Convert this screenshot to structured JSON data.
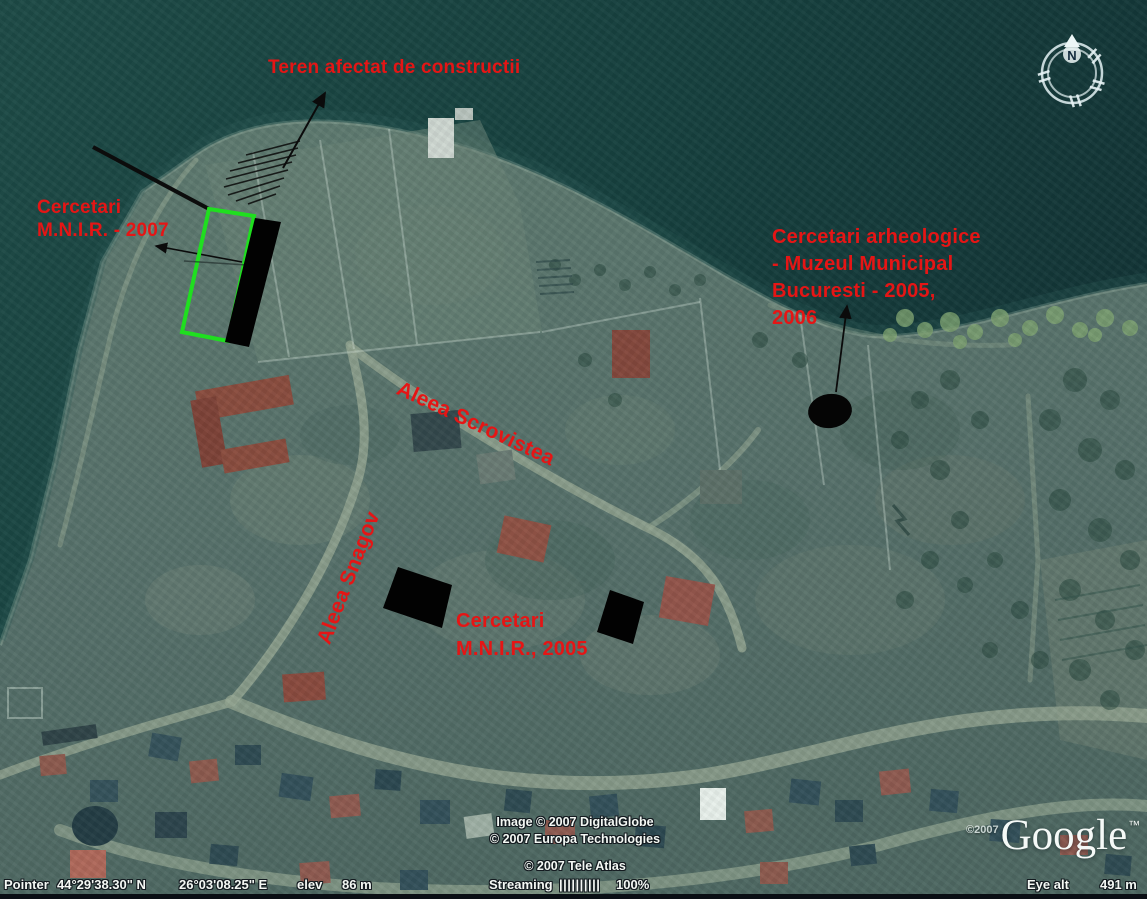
{
  "annotations": {
    "construction_label": "Teren afectat de constructii",
    "mnir_2007": {
      "line1": "Cercetari",
      "line2": "M.N.I.R. - 2007"
    },
    "museum_label": {
      "line1": "Cercetari arheologice",
      "line2": "- Muzeul Municipal",
      "line3": "Bucuresti - 2005,",
      "line4": "2006"
    },
    "mnir_2005": {
      "line1": "Cercetari",
      "line2": "M.N.I.R., 2005"
    },
    "street_scrovistea": "Aleea Scrovistea",
    "street_snagov": "Aleea Snagov",
    "colors": {
      "label_red": "#e51515",
      "trench_green": "#1fdf1f",
      "excavation_black": "#000000"
    }
  },
  "compass": {
    "north_label": "N"
  },
  "attribution": {
    "imagery_line1": "Image © 2007 DigitalGlobe",
    "imagery_line2": "© 2007 Europa Technologies",
    "map_line": "© 2007 Tele Atlas",
    "logo_year": "©2007",
    "logo_text": "Google",
    "logo_tm": "™"
  },
  "status_bar": {
    "pointer_label": "Pointer",
    "latitude": "44°29'38.30\" N",
    "longitude": "26°03'08.25\" E",
    "elev_label": "elev",
    "elevation": "86 m",
    "streaming_label": "Streaming",
    "streaming_bars": "||||||||||",
    "streaming_percent": "100%",
    "eye_alt_label": "Eye alt",
    "eye_alt": "491 m"
  }
}
